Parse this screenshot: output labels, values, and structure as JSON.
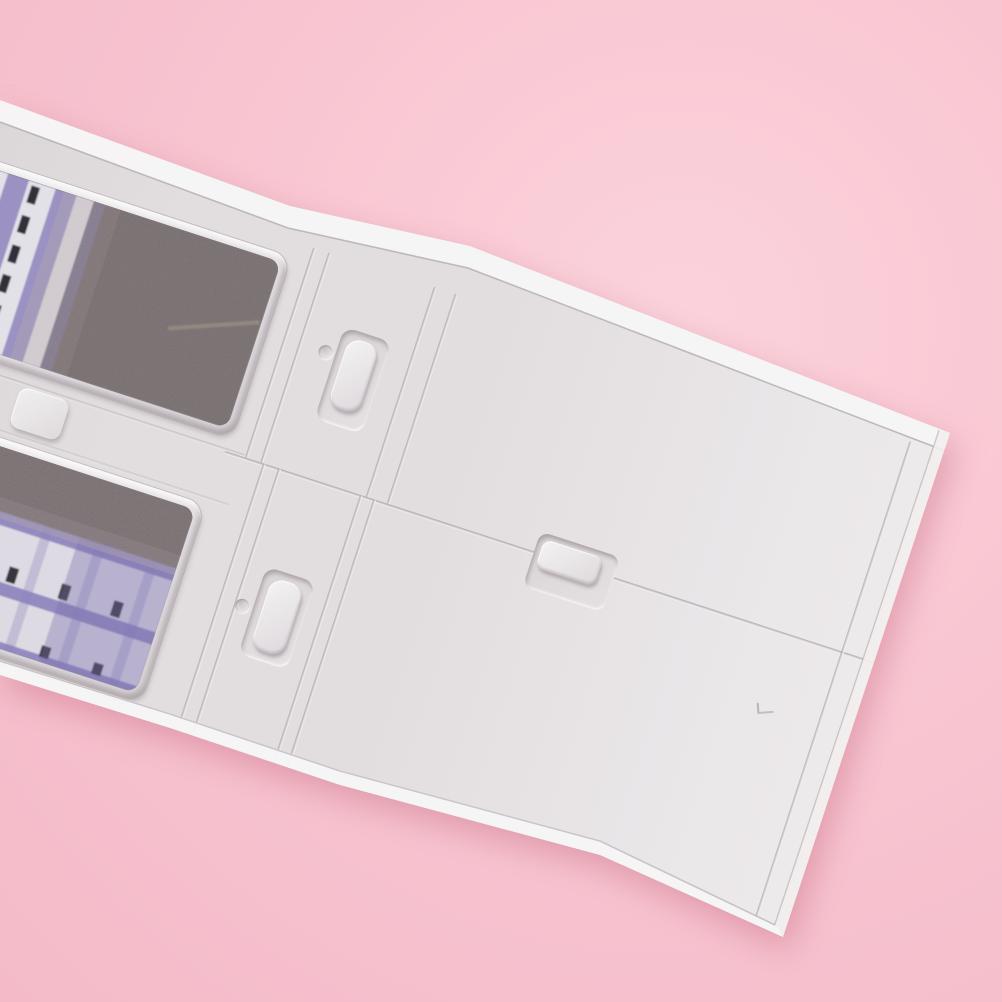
{
  "scene": {
    "description": "Macro product photo: white plastic miniature model building wall panel (with two printed display windows, sliding-door grooves and molded handles) lying diagonally on a plain pink background",
    "rotation_deg": 18,
    "silhouette_points": [
      [
        0,
        100
      ],
      [
        290,
        206
      ],
      [
        470,
        246
      ],
      [
        950,
        433
      ],
      [
        783,
        937
      ],
      [
        600,
        855
      ],
      [
        340,
        785
      ],
      [
        170,
        728
      ],
      [
        0,
        675
      ]
    ],
    "objects": {
      "background": "pink seamless backdrop",
      "panel": "white styrene model wall with molded door panels",
      "upper_window": "printed interior card: lavender striped facade with dark window dashes, dark brown area right",
      "lower_window": "printed interior card: dark brown band over lavender balcony grid with blue accent patch",
      "details": [
        "sliding-door-handle-upper",
        "sliding-door-handle-center",
        "sliding-door-handle-lower",
        "molded-dimples",
        "mounting-tab",
        "panel-grooves",
        "edge-highlights"
      ]
    },
    "css_vars": {
      "--bg": "#f8c5d1",
      "--bg-hi": "#fbd3dc",
      "--bg-lo": "#f4bac8",
      "--shadow": "rgba(197,106,130,0.45)",
      "--mat": "#e6e1e3",
      "--mat-dark": "#d6d0d3",
      "--mat-bright": "#f2eff1",
      "--mat-brightest": "#f7f5f6",
      "--groove": "#b2abaf",
      "--w1-stripe": "#8177bf",
      "--w1-panel": "#eff0f7",
      "--w1-dash": "#191723",
      "--w1-dark": "#594f4f",
      "--w2-band": "#837ac2",
      "--w2-panel": "#edebf4",
      "--w2-dash": "#191723",
      "--w2-dark": "#554c4c",
      "--w2-blue": "#3a48a6"
    }
  }
}
